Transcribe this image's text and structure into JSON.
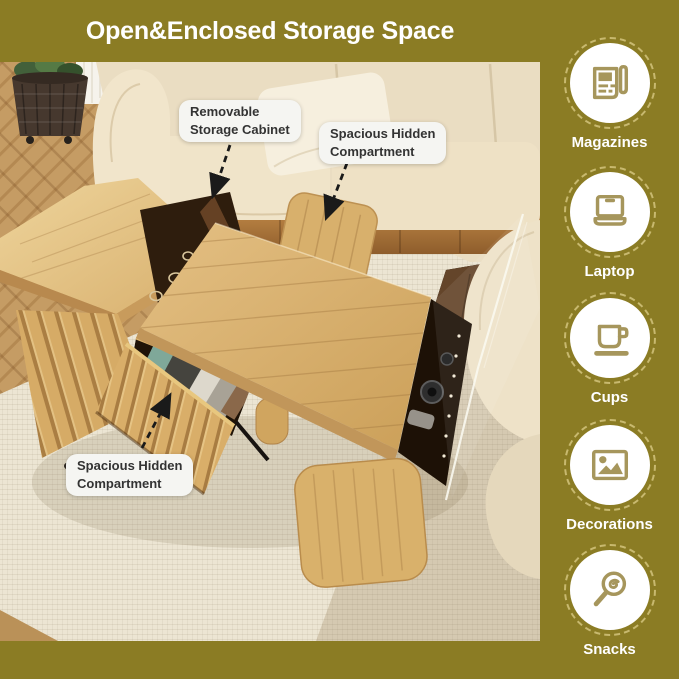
{
  "title": "Open&Enclosed Storage Space",
  "callouts": {
    "removable": {
      "line1": "Removable",
      "line2": "Storage Cabinet"
    },
    "hidden_top": {
      "line1": "Spacious Hidden",
      "line2": "Compartment"
    },
    "hidden_bottom": {
      "line1": "Spacious Hidden",
      "line2": "Compartment"
    }
  },
  "sidebar": {
    "items": [
      {
        "icon": "magazines-icon",
        "label": "Magazines"
      },
      {
        "icon": "laptop-icon",
        "label": "Laptop"
      },
      {
        "icon": "cups-icon",
        "label": "Cups"
      },
      {
        "icon": "decorations-icon",
        "label": "Decorations"
      },
      {
        "icon": "snacks-icon",
        "label": "Snacks"
      }
    ]
  },
  "colors": {
    "background": "#8B7C24",
    "title_text": "#FFFFFF",
    "callout_bg": "#F5F5F2",
    "callout_text": "#333333",
    "arrow": "#1A1A1A",
    "icon": "#A6965C",
    "badge_ring": "#C8B96F",
    "badge_bg": "#FFFFFF",
    "label_text": "#FFFFFF"
  }
}
